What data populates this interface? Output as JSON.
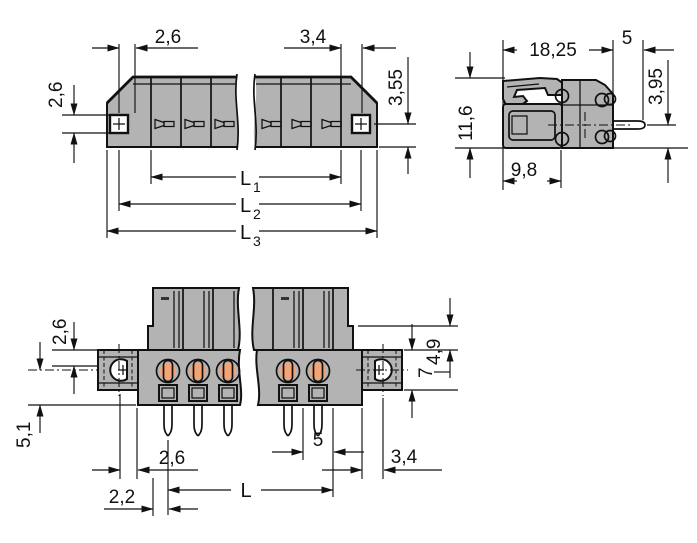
{
  "colors": {
    "background": "#ffffff",
    "housing": "#b3b3b3",
    "housing_inner": "#e9e9e9",
    "contact": "#f2a476",
    "outline": "#111111"
  },
  "top_view": {
    "dim_hole_to_edge": "2,6",
    "dim_end_offset": "3,4",
    "dim_hole_height": "2,6",
    "dim_contact_depth": "3,55",
    "l1_base": "L",
    "l1_sub": "1",
    "l2_base": "L",
    "l2_sub": "2",
    "l3_base": "L",
    "l3_sub": "3"
  },
  "side_view": {
    "dim_total_width": "18,25",
    "dim_pin_length": "5",
    "dim_height": "11,6",
    "dim_pin_axis": "3,95",
    "dim_housing_depth": "9,8"
  },
  "front_view": {
    "dim_flange_band": "2,6",
    "dim_pin_below": "5,1",
    "dim_shoulder": "4,9",
    "dim_flange_height": "7",
    "dim_hole_to_edge": "2,6",
    "dim_pitch": "5",
    "dim_end_offset": "3,4",
    "dim_span": "L",
    "dim_edge_to_pin": "2,2"
  }
}
